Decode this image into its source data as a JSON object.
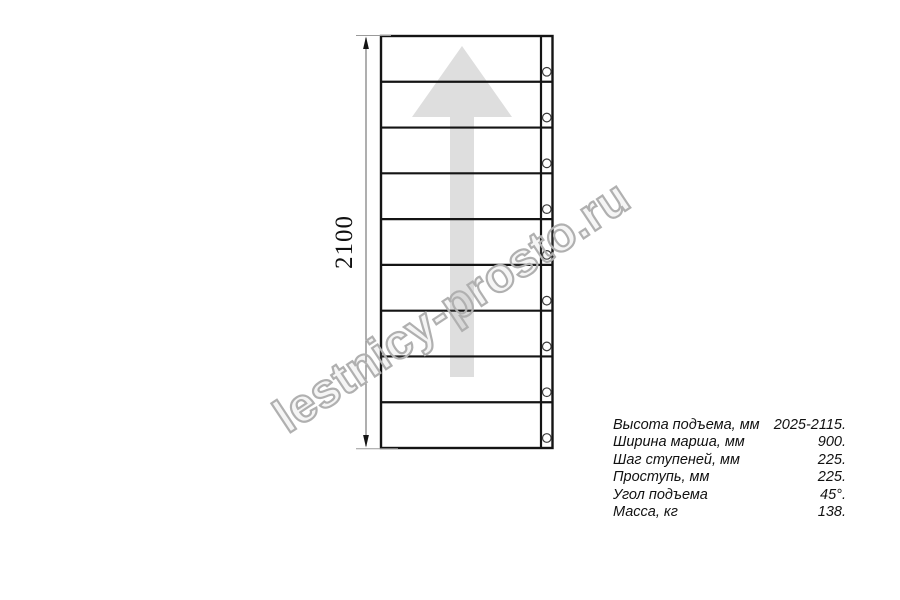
{
  "watermark": {
    "text": "lestnicy-prosto.ru",
    "color": "#b0b0b0"
  },
  "drawing": {
    "dimension_label": "2100",
    "steps_count": 9,
    "bolts_count": 9,
    "arrow_direction": "up",
    "line_color": "#141414",
    "arrow_color": "#dedede",
    "dim_line_color": "#7a7a7a",
    "ext_line_color": "#9a9a9a",
    "bolt_stroke_color": "#3a3a3a"
  },
  "specs": {
    "rows": [
      {
        "label": "Высота подъема, мм",
        "value": "2025-2115."
      },
      {
        "label": "Ширина марша, мм",
        "value": "900."
      },
      {
        "label": "Шаг ступеней, мм",
        "value": "225."
      },
      {
        "label": "Проступь, мм",
        "value": "225."
      },
      {
        "label": "Угол подъема",
        "value": "45°."
      },
      {
        "label": "Масса, кг",
        "value": "138."
      }
    ]
  }
}
